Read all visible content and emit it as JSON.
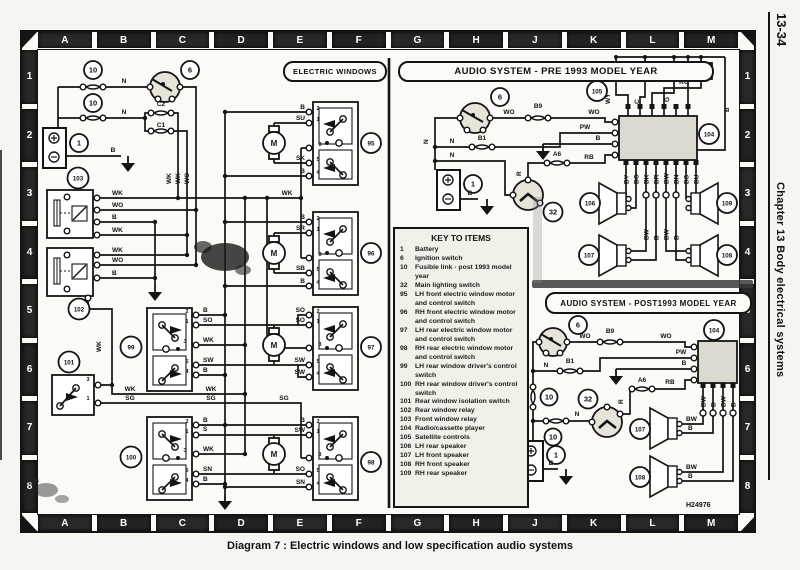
{
  "page": {
    "number": "13-34",
    "side_chapter": "Chapter 13 Body electrical systems",
    "caption": "Diagram 7 : Electric windows and low specification audio systems",
    "ref": "H24976"
  },
  "grid": {
    "cols": [
      "A",
      "B",
      "C",
      "D",
      "E",
      "F",
      "G",
      "H",
      "J",
      "K",
      "L",
      "M"
    ],
    "rows": [
      "1",
      "2",
      "3",
      "4",
      "5",
      "6",
      "7",
      "8"
    ]
  },
  "sections": {
    "ew": "ELECTRIC WINDOWS",
    "pre": "AUDIO SYSTEM - PRE 1993 MODEL YEAR",
    "post": "AUDIO SYSTEM - POST1993 MODEL YEAR"
  },
  "key": {
    "title": "KEY TO ITEMS",
    "items": [
      {
        "n": "1",
        "t": "Battery"
      },
      {
        "n": "6",
        "t": "Ignition switch"
      },
      {
        "n": "10",
        "t": "Fusible link - post 1993 model year"
      },
      {
        "n": "32",
        "t": "Main lighting switch"
      },
      {
        "n": "95",
        "t": "LH front electric window motor and control switch"
      },
      {
        "n": "96",
        "t": "RH front electric window motor and control switch"
      },
      {
        "n": "97",
        "t": "LH rear electric window motor and control switch"
      },
      {
        "n": "98",
        "t": "RH rear electric window motor and control switch"
      },
      {
        "n": "99",
        "t": "LH rear window driver's control switch"
      },
      {
        "n": "100",
        "t": "RH rear window driver's control switch"
      },
      {
        "n": "101",
        "t": "Rear window isolation switch"
      },
      {
        "n": "102",
        "t": "Rear window relay"
      },
      {
        "n": "103",
        "t": "Front window relay"
      },
      {
        "n": "104",
        "t": "Radio/cassette player"
      },
      {
        "n": "105",
        "t": "Satellite controls"
      },
      {
        "n": "106",
        "t": "LH rear speaker"
      },
      {
        "n": "107",
        "t": "LH front speaker"
      },
      {
        "n": "108",
        "t": "RH front speaker"
      },
      {
        "n": "109",
        "t": "RH rear speaker"
      }
    ]
  },
  "ew": {
    "tn": [
      "2",
      "1",
      "3",
      "5",
      "4"
    ],
    "m": "M",
    "badges": {
      "f10a": "10",
      "f10b": "10",
      "ign": "6",
      "bat": "1",
      "r103": "103",
      "r102": "102",
      "s101": "101",
      "s99": "99",
      "s100": "100",
      "u95": "95",
      "u96": "96",
      "u97": "97",
      "u98": "98"
    },
    "w": {
      "n1": "N",
      "n2": "N",
      "c2": "C2",
      "c1": "C1",
      "vwk1": "WK",
      "vwk2": "WK",
      "vwo": "WO",
      "batb": "B",
      "wkrot": "WK",
      "wkmid": "WK",
      "wkl": "WK",
      "wkr": "WK",
      "sgl": "SG",
      "sgr": "SG",
      "sgmid": "SG",
      "t3": "3",
      "t1": "1"
    },
    "r103": [
      "WK",
      "WO",
      "B",
      "WK"
    ],
    "r102": [
      "WK",
      "WO",
      "B"
    ],
    "u95": [
      "B",
      "SU",
      "SK",
      "B"
    ],
    "u96": [
      "B",
      "SR",
      "SB",
      "B"
    ],
    "u97": [
      "SO",
      "SO",
      "SW",
      "SW"
    ],
    "u98": [
      "B",
      "SW",
      "SO",
      "SN"
    ],
    "s99": [
      "B",
      "SO",
      "WK",
      "SW",
      "B"
    ],
    "s100": [
      "B",
      "S",
      "WK",
      "SN",
      "B"
    ]
  },
  "pre": {
    "badges": {
      "ign": "6",
      "bat": "1",
      "ls": "32",
      "radio": "104",
      "sat": "105",
      "sp106": "106",
      "sp107": "107",
      "sp108": "108",
      "sp109": "109"
    },
    "w": {
      "wo1": "WO",
      "b9": "B9",
      "wo2": "WO",
      "nrot": "N",
      "n1": "N",
      "b1": "B1",
      "n2": "N",
      "pw": "PW",
      "b": "B",
      "a6": "A6",
      "rb": "RB",
      "r": "R",
      "batb": "B",
      "rg": "RG",
      "s1": "WY",
      "s2": "C",
      "s3": "G",
      "sb": "B"
    },
    "seek": "SEEK",
    "pins": [
      "BY",
      "BO",
      "BK",
      "BR",
      "BW",
      "BN",
      "BS",
      "BU"
    ],
    "mid": [
      "BW",
      "B",
      "BW",
      "B"
    ]
  },
  "post": {
    "badges": {
      "ign": "6",
      "bat": "1",
      "ls": "32",
      "radio": "104",
      "sp107": "107",
      "sp108": "108",
      "f10a": "10",
      "f10b": "10"
    },
    "w": {
      "wo1": "WO",
      "b9": "B9",
      "wo2": "WO",
      "nrot": "N",
      "n1": "N",
      "b1": "B1",
      "n2": "N",
      "pw": "PW",
      "b": "B",
      "a6": "A6",
      "rb": "RB",
      "r": "R",
      "batb": "B",
      "bw1": "BW",
      "bb1": "B",
      "bw2": "BW",
      "bb2": "B"
    },
    "pins": [
      "BW",
      "B",
      "BW",
      "B"
    ]
  }
}
